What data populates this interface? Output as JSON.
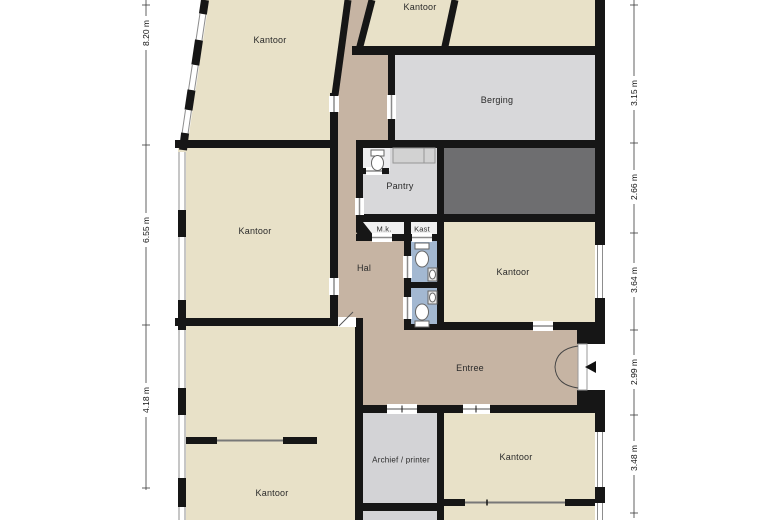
{
  "plan": {
    "rooms": {
      "kantoor_top_left": "Kantoor",
      "kantoor_top_mid": "Kantoor",
      "berging": "Berging",
      "pantry": "Pantry",
      "meterkast": "M.k.",
      "kast": "Kast",
      "hal": "Hal",
      "kantoor_mid_left": "Kantoor",
      "kantoor_mid_right": "Kantoor",
      "entree": "Entree",
      "archief_printer": "Archief / printer",
      "kantoor_bottom_left": "Kantoor",
      "kantoor_bottom_right": "Kantoor"
    },
    "dimensions": {
      "left": [
        "8.20 m",
        "6.55 m",
        "4.18 m"
      ],
      "right": [
        "3.15 m",
        "2.66 m",
        "3.64 m",
        "2.99 m",
        "3.48 m"
      ]
    },
    "colors": {
      "room_beige": "#e8e1c8",
      "corridor_tan": "#c6b4a3",
      "utility_gray": "#d8d8da",
      "dark_room_gray": "#6e6e70",
      "toilet_blue": "#a3b8d1",
      "wall_black": "#161616"
    }
  }
}
